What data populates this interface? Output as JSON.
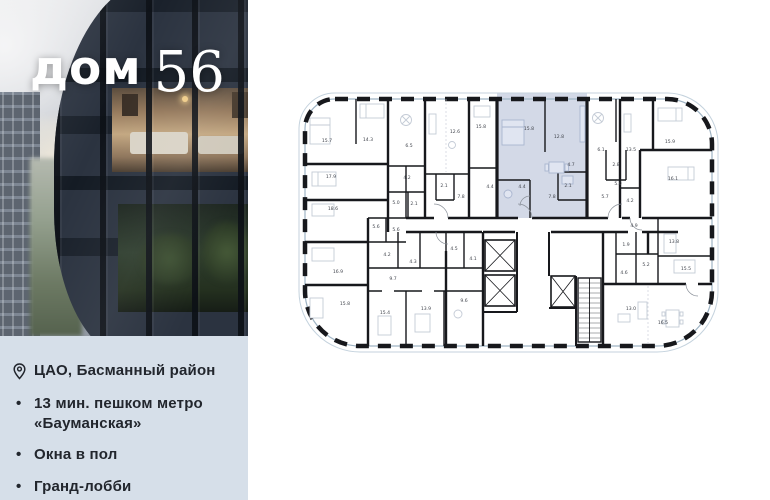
{
  "brand": {
    "name_word": "дом",
    "name_number": "56"
  },
  "info_panel": {
    "location": "ЦАО, Басманный район",
    "features": [
      "13 мин. пешком метро «Бауманская»",
      "Окна в пол",
      "Гранд-лобби"
    ]
  },
  "colors": {
    "panel_bg": "#d6dfe9",
    "highlight_apartment": "#d3d9e7",
    "wall": "#17181c",
    "glazing": "#a9bccb",
    "text_dark": "#22262d"
  },
  "floor_plan": {
    "highlighted_unit_rooms": [
      "15.8",
      "12.8",
      "4.7",
      "4.4",
      "2.1",
      "7.8"
    ],
    "rooms": [
      {
        "x": 41,
        "y": 54,
        "label": "15.7",
        "hl": false
      },
      {
        "x": 82,
        "y": 53,
        "label": "14.3",
        "hl": false
      },
      {
        "x": 123,
        "y": 59,
        "label": "6.5",
        "hl": false
      },
      {
        "x": 169,
        "y": 45,
        "label": "12.6",
        "hl": false
      },
      {
        "x": 195,
        "y": 40,
        "label": "15.8",
        "hl": false
      },
      {
        "x": 243,
        "y": 42,
        "label": "15.8",
        "hl": true
      },
      {
        "x": 273,
        "y": 50,
        "label": "12.8",
        "hl": true
      },
      {
        "x": 285,
        "y": 78,
        "label": "4.7",
        "hl": true
      },
      {
        "x": 315,
        "y": 63,
        "label": "6.1",
        "hl": false
      },
      {
        "x": 345,
        "y": 63,
        "label": "13.5",
        "hl": false
      },
      {
        "x": 384,
        "y": 55,
        "label": "15.9",
        "hl": false
      },
      {
        "x": 45,
        "y": 90,
        "label": "17.9",
        "hl": false
      },
      {
        "x": 121,
        "y": 91,
        "label": "4.2",
        "hl": false
      },
      {
        "x": 158,
        "y": 99,
        "label": "2.1",
        "hl": false
      },
      {
        "x": 204,
        "y": 100,
        "label": "4.4",
        "hl": false
      },
      {
        "x": 236,
        "y": 100,
        "label": "4.4",
        "hl": true
      },
      {
        "x": 282,
        "y": 99,
        "label": "2.1",
        "hl": true
      },
      {
        "x": 330,
        "y": 78,
        "label": "2.8",
        "hl": false
      },
      {
        "x": 332,
        "y": 97,
        "label": "5.0",
        "hl": false
      },
      {
        "x": 387,
        "y": 92,
        "label": "16.1",
        "hl": false
      },
      {
        "x": 47,
        "y": 122,
        "label": "18.6",
        "hl": false
      },
      {
        "x": 110,
        "y": 116,
        "label": "5.0",
        "hl": false
      },
      {
        "x": 128,
        "y": 117,
        "label": "2.1",
        "hl": false
      },
      {
        "x": 175,
        "y": 110,
        "label": "7.8",
        "hl": false
      },
      {
        "x": 266,
        "y": 110,
        "label": "7.8",
        "hl": true
      },
      {
        "x": 319,
        "y": 110,
        "label": "5.7",
        "hl": false
      },
      {
        "x": 344,
        "y": 114,
        "label": "4.2",
        "hl": false
      },
      {
        "x": 90,
        "y": 140,
        "label": "5.6",
        "hl": false
      },
      {
        "x": 110,
        "y": 143,
        "label": "5.6",
        "hl": false
      },
      {
        "x": 348,
        "y": 139,
        "label": "4.9",
        "hl": false
      },
      {
        "x": 52,
        "y": 185,
        "label": "16.9",
        "hl": false
      },
      {
        "x": 101,
        "y": 168,
        "label": "4.2",
        "hl": false
      },
      {
        "x": 127,
        "y": 175,
        "label": "4.3",
        "hl": false
      },
      {
        "x": 168,
        "y": 162,
        "label": "4.5",
        "hl": false
      },
      {
        "x": 187,
        "y": 172,
        "label": "4.1",
        "hl": false
      },
      {
        "x": 340,
        "y": 158,
        "label": "1.9",
        "hl": false
      },
      {
        "x": 360,
        "y": 178,
        "label": "5.2",
        "hl": false
      },
      {
        "x": 338,
        "y": 186,
        "label": "4.6",
        "hl": false
      },
      {
        "x": 388,
        "y": 155,
        "label": "13.8",
        "hl": false
      },
      {
        "x": 400,
        "y": 182,
        "label": "15.5",
        "hl": false
      },
      {
        "x": 107,
        "y": 192,
        "label": "9.7",
        "hl": false
      },
      {
        "x": 59,
        "y": 217,
        "label": "15.8",
        "hl": false
      },
      {
        "x": 99,
        "y": 226,
        "label": "15.4",
        "hl": false
      },
      {
        "x": 140,
        "y": 222,
        "label": "13.9",
        "hl": false
      },
      {
        "x": 178,
        "y": 214,
        "label": "9.6",
        "hl": false
      },
      {
        "x": 345,
        "y": 222,
        "label": "13.0",
        "hl": false
      },
      {
        "x": 377,
        "y": 236,
        "label": "16.5",
        "hl": false
      }
    ]
  }
}
